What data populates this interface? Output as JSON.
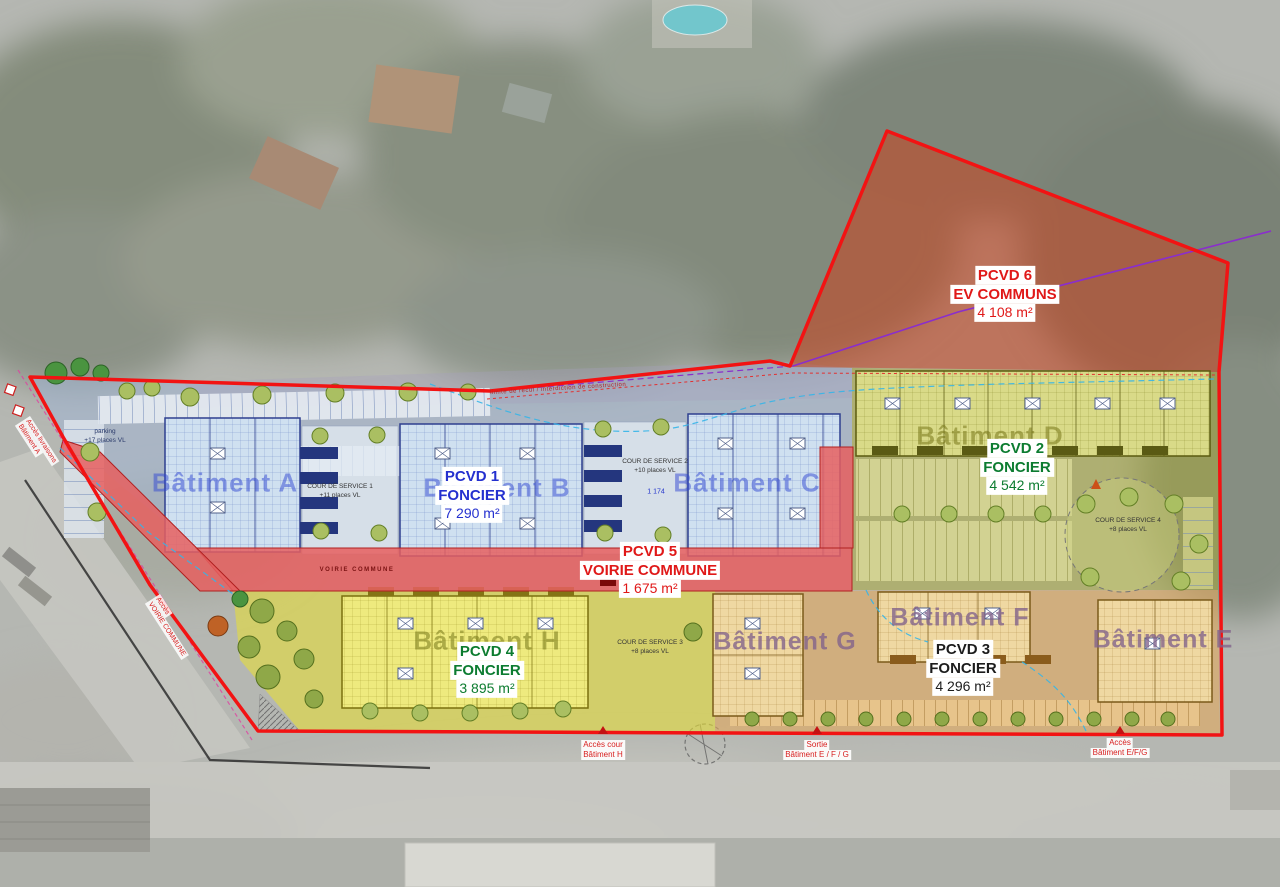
{
  "zones": [
    {
      "name": "PCVD 1",
      "category": "FONCIER",
      "area": "7 290 m²",
      "color": "#2430cf"
    },
    {
      "name": "PCVD 2",
      "category": "FONCIER",
      "area": "4 542 m²",
      "color": "#0c7c30"
    },
    {
      "name": "PCVD 3",
      "category": "FONCIER",
      "area": "4 296 m²",
      "color": "#1c1c1c"
    },
    {
      "name": "PCVD 4",
      "category": "FONCIER",
      "area": "3 895 m²",
      "color": "#0c7c30"
    },
    {
      "name": "PCVD 5",
      "category": "VOIRIE COMMUNE",
      "area": "1 675 m²",
      "color": "#e01818"
    },
    {
      "name": "PCVD 6",
      "category": "EV COMMUNS",
      "area": "4 108 m²",
      "color": "#e01818"
    }
  ],
  "buildings": [
    {
      "label": "Bâtiment A"
    },
    {
      "label": "Bâtiment B"
    },
    {
      "label": "Bâtiment C"
    },
    {
      "label": "Bâtiment D"
    },
    {
      "label": "Bâtiment E"
    },
    {
      "label": "Bâtiment F"
    },
    {
      "label": "Bâtiment G"
    },
    {
      "label": "Bâtiment H"
    }
  ],
  "access": [
    {
      "line1": "Accès cour",
      "line2": "Bâtiment H"
    },
    {
      "line1": "Sortie",
      "line2": "Bâtiment E / F / G"
    },
    {
      "line1": "Accès",
      "line2": "Bâtiment E/F/G"
    },
    {
      "line1": "Accès livraisons",
      "line2": "Bâtiment A"
    },
    {
      "line1": "Accès",
      "line2": "VOIRIE COMMUNE"
    }
  ],
  "annotations": {
    "parking1": {
      "line1": "parking",
      "line2": "+17 places VL"
    },
    "cour1": {
      "line1": "COUR DE SERVICE 1",
      "line2": "+11 places VL"
    },
    "cour2": {
      "line1": "COUR DE SERVICE 2",
      "line2": "+10 places VL"
    },
    "cour3": {
      "line1": "COUR DE SERVICE 3",
      "line2": "+8 places VL"
    },
    "cour4": {
      "line1": "COUR DE SERVICE 4",
      "line2": "+8 places VL"
    },
    "road": "VOIRIE COMMUNE",
    "dim1": "1 174",
    "setback": "limite de recul / interdiction de construction"
  },
  "colors": {
    "boundary": "#f21313",
    "pcvd6_fill": "#c24a28",
    "zone_blue": "#9fb4d4",
    "zone_olive": "#a8a832",
    "zone_yellow": "#e4dc3e",
    "zone_orange": "#e2a85c",
    "road_red": "#e58585",
    "utility_blue": "#35b5e8",
    "utility_purple": "#8a2ecc",
    "label_blue": "#2430cf",
    "label_green": "#0c7c30",
    "label_red": "#e01818"
  }
}
